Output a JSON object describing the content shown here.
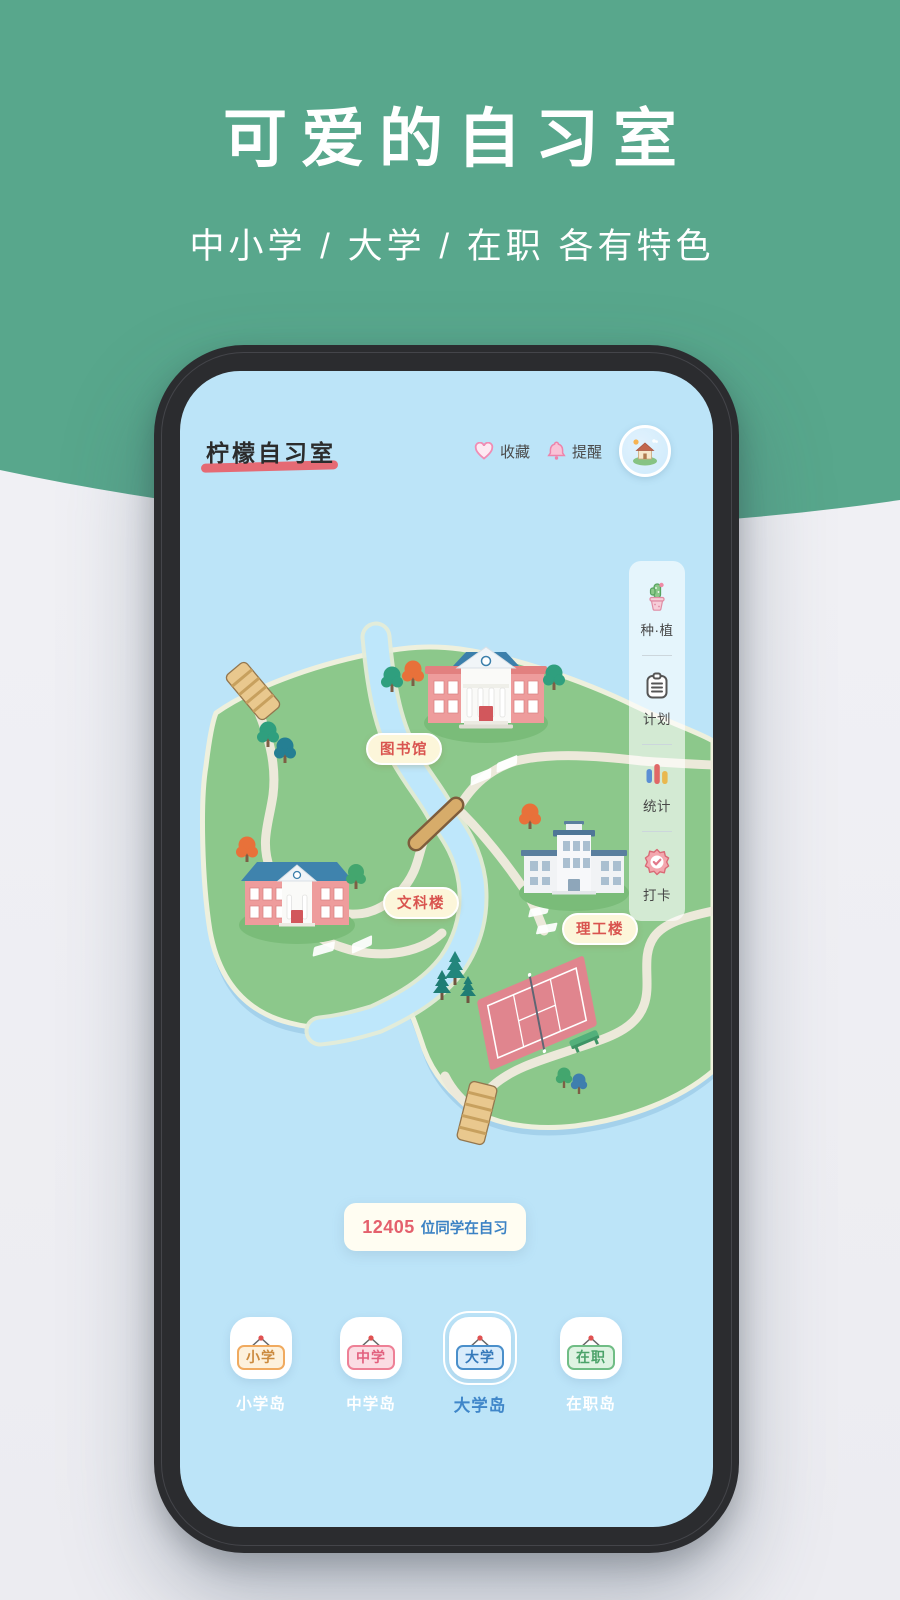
{
  "hero": {
    "title": "可爱的自习室",
    "subtitle": "中小学 / 大学 / 在职 各有特色"
  },
  "app": {
    "logo": "柠檬自习室",
    "header": {
      "favorites": "收藏",
      "reminders": "提醒"
    },
    "sidebar": [
      {
        "icon": "potted-plant-icon",
        "label": "种·植"
      },
      {
        "icon": "plan-clipboard-icon",
        "label": "计划"
      },
      {
        "icon": "stats-bars-icon",
        "label": "统计"
      },
      {
        "icon": "checkin-badge-icon",
        "label": "打卡"
      }
    ],
    "map": {
      "library_label": "图书馆",
      "liberal_arts_label": "文科楼",
      "science_label": "理工楼"
    },
    "banner": {
      "count": "12405",
      "suffix": "位同学在自习"
    },
    "tabs": [
      {
        "sign": "小学",
        "label": "小学岛",
        "active": false,
        "color": "#f0aa5f"
      },
      {
        "sign": "中学",
        "label": "中学岛",
        "active": false,
        "color": "#ee8096"
      },
      {
        "sign": "大学",
        "label": "大学岛",
        "active": true,
        "color": "#4a8fca"
      },
      {
        "sign": "在职",
        "label": "在职岛",
        "active": false,
        "color": "#70bd85"
      }
    ]
  },
  "colors": {
    "hero_green": "#58a78c",
    "screen_blue": "#bce4f8",
    "island_green": "#8cc88b",
    "accent_red": "#e4606d",
    "accent_blue": "#3b82c4",
    "map_label_red": "#d9544f",
    "logo_underline": "#e56a74"
  }
}
